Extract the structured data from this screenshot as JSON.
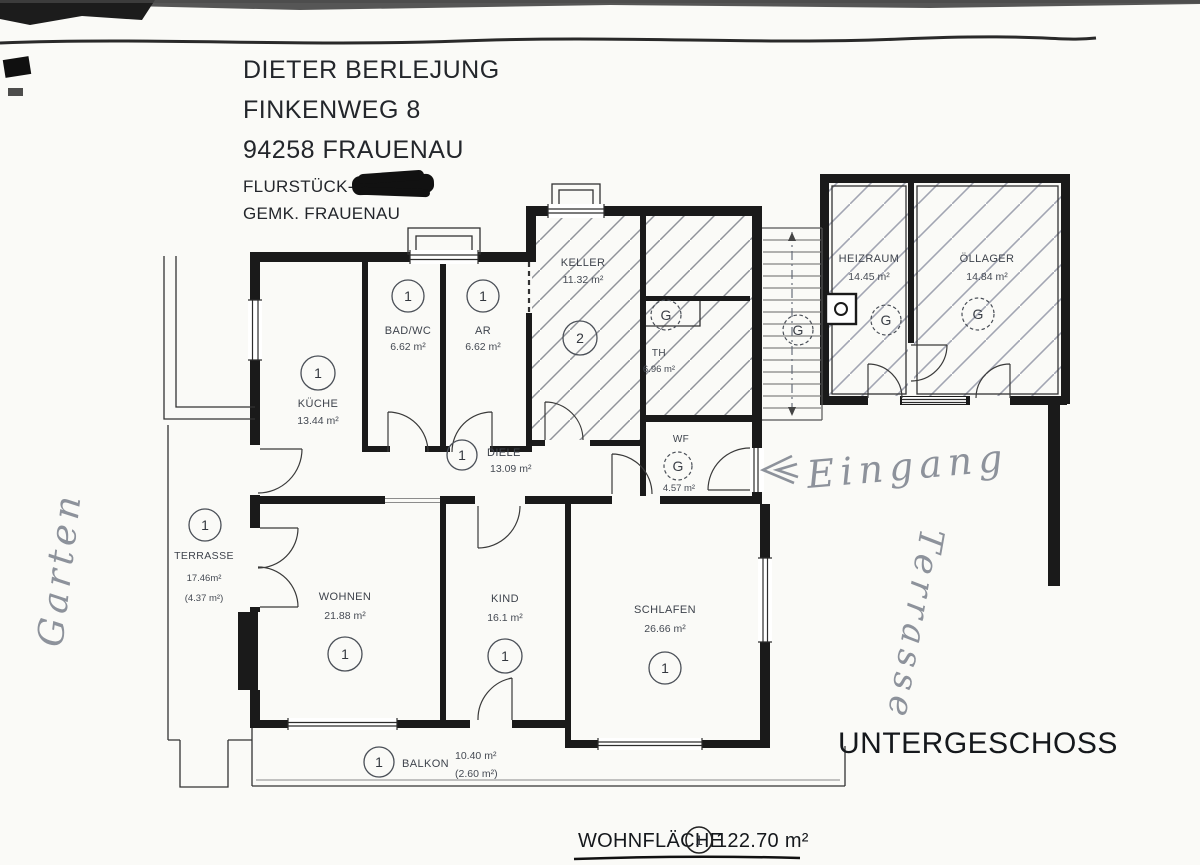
{
  "stamp": {
    "line1": "DIETER BERLEJUNG",
    "line2": "FINKENWEG 8",
    "line3": "94258 FRAUENAU",
    "flur_label": "FLURSTÜCK-NR.",
    "gemk": "GEMK. FRAUENAU"
  },
  "plan_title": "UNTERGESCHOSS",
  "summary": {
    "label": "WOHNFLÄCHE",
    "marker": "1",
    "value": "122.70 m²"
  },
  "handwritten": {
    "garten": "Garten",
    "eingang": "Eingang",
    "terrasse": "Terrasse"
  },
  "markers": {
    "hall": "G",
    "stairs": "G"
  },
  "rooms": {
    "kueche": {
      "name": "KÜCHE",
      "area": "13.44 m²",
      "marker": "1"
    },
    "badwc": {
      "name": "BAD/WC",
      "area": "6.62 m²",
      "marker": "1"
    },
    "ar": {
      "name": "AR",
      "area": "6.62 m²",
      "marker": "1"
    },
    "keller": {
      "name": "KELLER",
      "area": "11.32 m²",
      "marker": "2"
    },
    "th": {
      "name": "TH",
      "area": "6.96 m²"
    },
    "diele": {
      "name": "DIELE",
      "area": "13.09 m²",
      "marker": "1"
    },
    "wf": {
      "name": "WF",
      "area": "4.57 m²",
      "marker": "G"
    },
    "terrasse": {
      "name": "TERRASSE",
      "area": "17.46m²",
      "area2": "(4.37 m²)",
      "marker": "1"
    },
    "wohnen": {
      "name": "WOHNEN",
      "area": "21.88 m²",
      "marker": "1"
    },
    "kind": {
      "name": "KIND",
      "area": "16.1 m²",
      "marker": "1"
    },
    "schlafen": {
      "name": "SCHLAFEN",
      "area": "26.66 m²",
      "marker": "1"
    },
    "balkon": {
      "name": "BALKON",
      "area": "10.40 m²",
      "area2": "(2.60 m²)",
      "marker": "1"
    },
    "heizraum": {
      "name": "HEIZRAUM",
      "area": "14.45 m²",
      "marker": "G"
    },
    "oellager": {
      "name": "ÖLLAGER",
      "area": "14.84 m²",
      "marker": "G"
    }
  }
}
